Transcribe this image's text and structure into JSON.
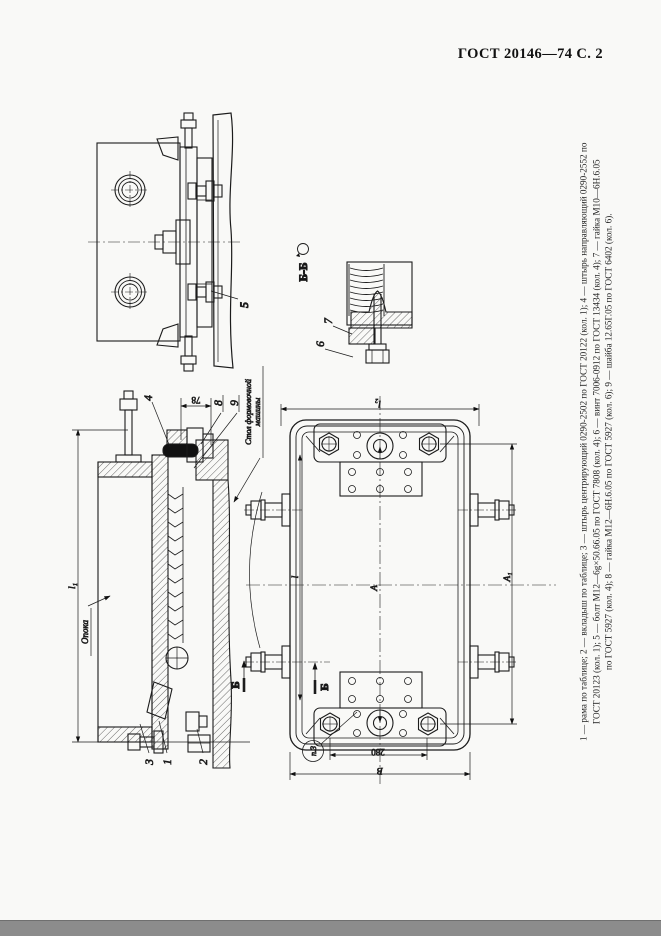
{
  "header": {
    "title": "ГОСТ 20146—74 С. 2"
  },
  "caption": {
    "line1": "1 — рама по таблице; 2 — вкладыш по таблице; 3 — штырь центрирующий 0290-2502 по ГОСТ 20122 (кол. 1); 4 — штырь направляющий 0290-2552 по",
    "line2": "ГОСТ 20123 (кол. 1); 5 — болт М12—6g×50.66.05 по ГОСТ 7808 (кол. 4); 6 — винт 7006-0912 по ГОСТ 13434 (кол. 4); 7 — гайка М10—6Н.6.05",
    "line3": "по ГОСТ 5927 (кол. 4); 8 — гайка М12—6Н.6.05 по ГОСТ 5927 (кол. 6); 9 — шайба 12.65Г.05 по ГОСТ 6402 (кол. 6)."
  },
  "labels": {
    "opoka": "Опока",
    "machine_table_line1": "Стол формовочной",
    "machine_table_line2": "машины",
    "section_view_title": "Б-Б",
    "section_letter": "Б",
    "balloon_note": "п.3"
  },
  "callouts": {
    "pos1": "1",
    "pos2": "2",
    "pos3": "3",
    "pos4": "4",
    "pos5": "5",
    "pos6": "6",
    "pos7": "7",
    "pos8": "8",
    "pos9": "9"
  },
  "dimensions": {
    "height_total": "l₁",
    "width_78": "78",
    "plan_top": "l₂",
    "plan_l": "l",
    "plan_A": "А",
    "plan_A1": "А₁",
    "plan_280": "280",
    "plan_B": "В"
  },
  "colors": {
    "line": "#1c1c1c",
    "paper": "#f9f9f7",
    "footer_strip": "#8c8c8c"
  }
}
